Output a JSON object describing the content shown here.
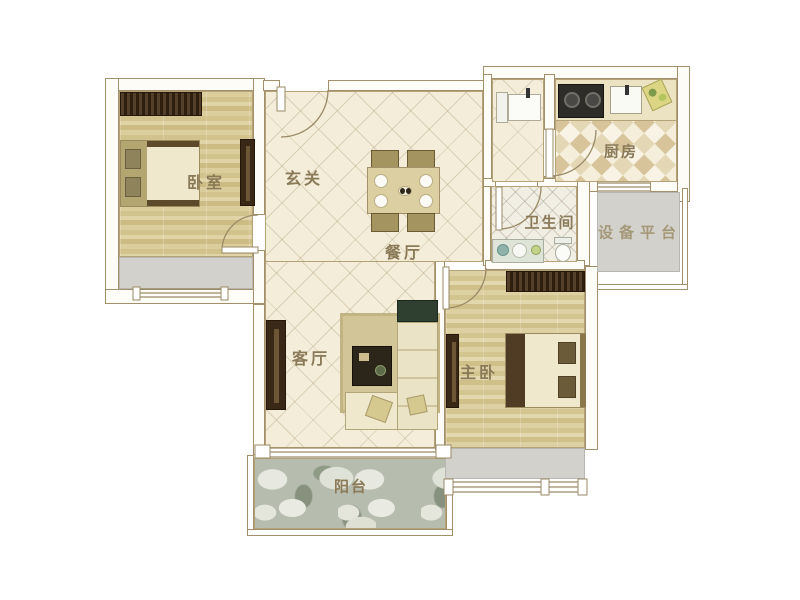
{
  "floor_plan": {
    "type": "residential-floor-plan",
    "rooms": [
      {
        "id": "bedroom",
        "label": "卧室"
      },
      {
        "id": "foyer",
        "label": "玄关"
      },
      {
        "id": "dining-room",
        "label": "餐厅"
      },
      {
        "id": "kitchen",
        "label": "厨房"
      },
      {
        "id": "bathroom",
        "label": "卫生间"
      },
      {
        "id": "equipment-platform",
        "label": "设备平台"
      },
      {
        "id": "living-room",
        "label": "客厅"
      },
      {
        "id": "master-bedroom",
        "label": "主卧"
      },
      {
        "id": "balcony",
        "label": "阳台"
      }
    ],
    "colors": {
      "wall_line": "#a2906c",
      "wood_floor": "#d6c792",
      "tile_floor": "#f3edda",
      "kitchen_tile": "#d7c49a",
      "bath_tile": "#f1eee4",
      "balcony_stone": "#b6bcae",
      "bay_window_gray": "#d2d1cc",
      "furniture_dark": "#3a2817",
      "label_text": "#8a7a58"
    }
  }
}
